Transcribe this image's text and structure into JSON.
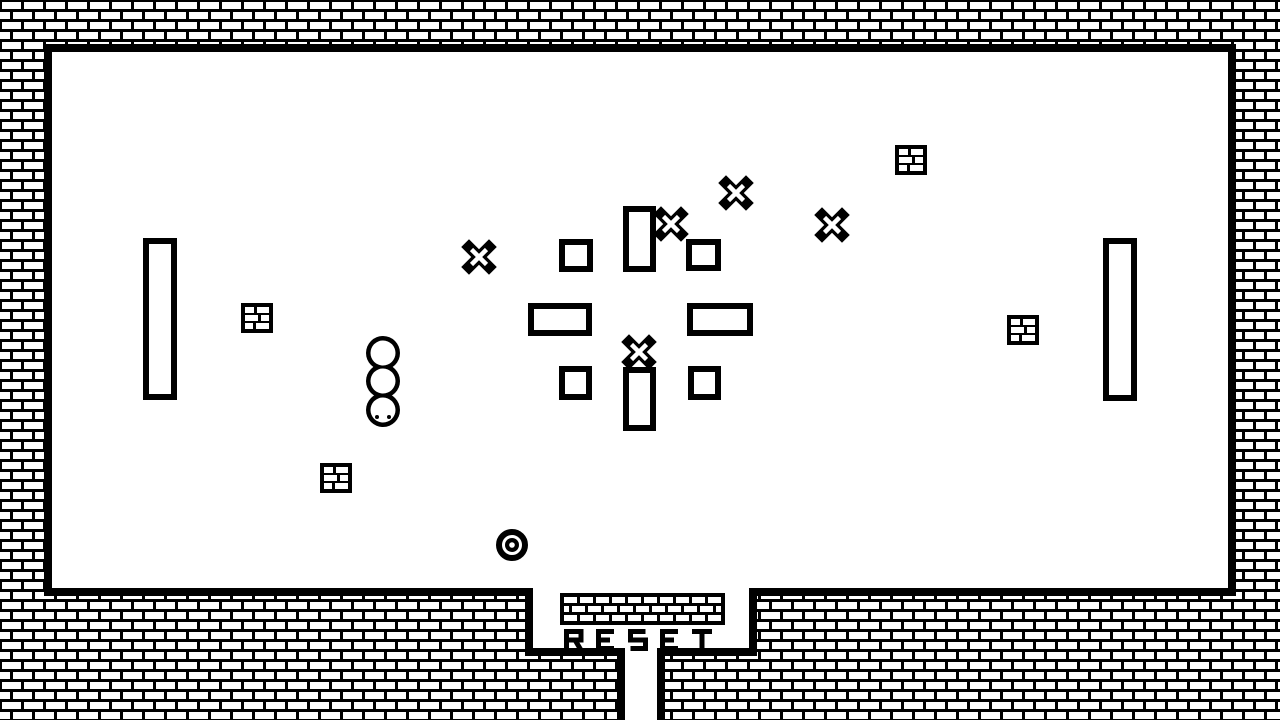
{
  "colors": {
    "ink": "#000000",
    "paper": "#ffffff"
  },
  "hud": {
    "reset_label": "RESET"
  },
  "objects": {
    "white_blocks": [
      {
        "x": 143,
        "y": 238,
        "w": 34,
        "h": 162
      },
      {
        "x": 1103,
        "y": 238,
        "w": 34,
        "h": 163
      },
      {
        "x": 559,
        "y": 239,
        "w": 34,
        "h": 33
      },
      {
        "x": 686,
        "y": 239,
        "w": 35,
        "h": 32
      },
      {
        "x": 559,
        "y": 366,
        "w": 33,
        "h": 34
      },
      {
        "x": 688,
        "y": 366,
        "w": 33,
        "h": 34
      },
      {
        "x": 528,
        "y": 303,
        "w": 64,
        "h": 33
      },
      {
        "x": 687,
        "y": 303,
        "w": 66,
        "h": 33
      },
      {
        "x": 623,
        "y": 206,
        "w": 33,
        "h": 66
      },
      {
        "x": 623,
        "y": 367,
        "w": 33,
        "h": 64
      }
    ],
    "x_marks": [
      {
        "cx": 479,
        "cy": 257
      },
      {
        "cx": 671,
        "cy": 224
      },
      {
        "cx": 736,
        "cy": 193
      },
      {
        "cx": 832,
        "cy": 225
      },
      {
        "cx": 639,
        "cy": 352
      }
    ],
    "brick_blocks": [
      {
        "x": 241,
        "y": 303
      },
      {
        "x": 320,
        "y": 463
      },
      {
        "x": 895,
        "y": 145
      },
      {
        "x": 1007,
        "y": 315
      }
    ],
    "creature": {
      "cx": 383,
      "r": 17,
      "inner_r": 12.5,
      "bumps": [
        353,
        381,
        410
      ],
      "eyes": [
        [
          377,
          417
        ],
        [
          389,
          417
        ]
      ],
      "eye_r": 2
    },
    "goal": {
      "cx": 512,
      "cy": 545,
      "ring_r": 13,
      "ring_w": 6,
      "dot_r": 7,
      "hole_r": 2.8
    }
  }
}
